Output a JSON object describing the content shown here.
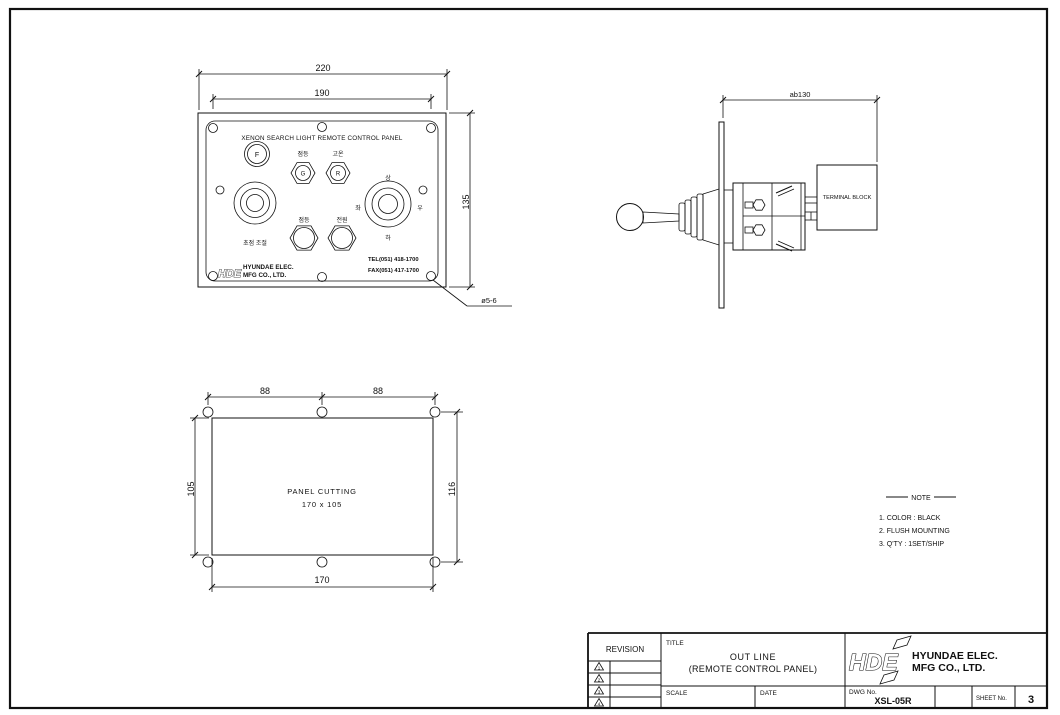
{
  "sheet": {
    "front_view": {
      "title": "XENON SEARCH LIGHT REMOTE CONTROL PANEL",
      "dim_outer_width": "220",
      "dim_hole_span": "190",
      "dim_height": "135",
      "hole_callout": "ø5-6",
      "fuse_letter": "F",
      "lamp_g_letter": "G",
      "lamp_g_label": "점등",
      "lamp_r_letter": "R",
      "lamp_r_label": "고온",
      "switch_left_label": "점등",
      "switch_right_label": "전원",
      "focus_knob_label": "초점 조절",
      "joystick": {
        "up": "상",
        "left": "좌",
        "right": "우",
        "down": "하"
      },
      "logo_abbr": "HDE",
      "logo_line1": "HYUNDAE ELEC.",
      "logo_line2": "MFG CO., LTD.",
      "tel": "TEL(051) 418-1700",
      "fax": "FAX(051) 417-1700"
    },
    "side_view": {
      "dim_depth": "ab130",
      "terminal_block_label": "TERMINAL BLOCK"
    },
    "cutting_view": {
      "dim_top_left": "88",
      "dim_top_right": "88",
      "dim_left": "105",
      "dim_right": "116",
      "dim_bottom": "170",
      "label_line1": "PANEL CUTTING",
      "label_line2": "170 x 105"
    },
    "note": {
      "title": "NOTE",
      "items": [
        "1. COLOR : BLACK",
        "2. FLUSH MOUNTING",
        "3. Q'TY : 1SET/SHIP"
      ]
    },
    "title_block": {
      "revision_label": "REVISION",
      "revision_marks": [
        "1",
        "2",
        "3",
        "4"
      ],
      "title_label": "TITLE",
      "title_line1": "OUT LINE",
      "title_line2": "(REMOTE CONTROL PANEL)",
      "logo_abbr": "HDE",
      "logo_line1": "HYUNDAE ELEC.",
      "logo_line2": "MFG CO., LTD.",
      "scale_label": "SCALE",
      "date_label": "DATE",
      "dwg_label": "DWG No.",
      "dwg_value": "XSL-05R",
      "sheet_label": "SHEET No.",
      "sheet_value": "3"
    }
  }
}
